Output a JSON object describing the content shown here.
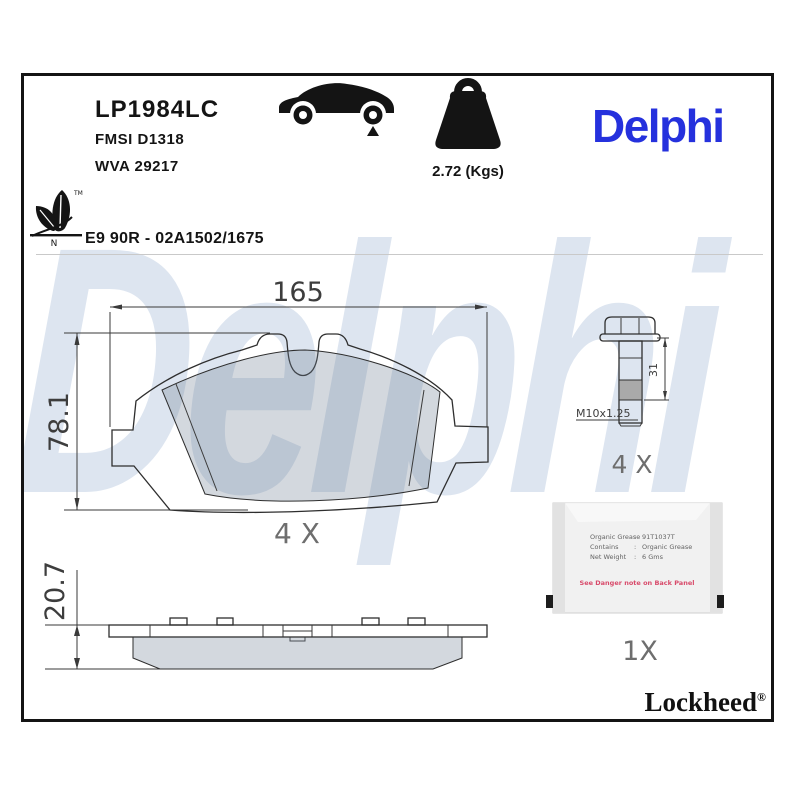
{
  "header": {
    "part_number": "LP1984LC",
    "fmsi": "FMSI D1318",
    "wva": "WVA 29217",
    "weight": "2.72 (Kgs)",
    "brand": "Delphi",
    "eco_tm": "TM",
    "eco_n": "N",
    "homologation": "E9 90R - 02A1502/1675"
  },
  "watermark": {
    "text": "Delphi"
  },
  "front_view": {
    "width_dim": "165",
    "height_dim": "78.1",
    "qty": "4 X"
  },
  "side_view": {
    "thickness_dim": "20.7"
  },
  "bolt": {
    "length_dim": "31",
    "thread": "M10x1.25",
    "qty": "4 X"
  },
  "grease": {
    "qty": "1X",
    "separator": ":",
    "line1_label": "Organic Grease",
    "line1_value": "91T1037T",
    "line2_label": "Contains",
    "line2_value": "Organic Grease",
    "line3_label": "Net Weight",
    "line3_value": "6 Gms",
    "warning": "See Danger note on Back Panel"
  },
  "footer": {
    "brand": "Lockheed",
    "registered": "®"
  },
  "colors": {
    "brand_blue": "#2531dd",
    "watermark_blue": "#dde5f0",
    "warning_red": "#d84a6a",
    "friction_gray": "rgba(110,125,145,0.30)"
  }
}
